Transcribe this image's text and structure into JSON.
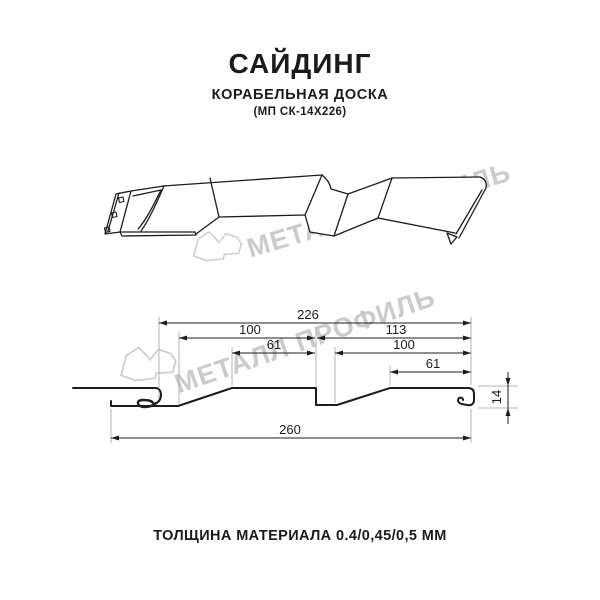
{
  "header": {
    "title": "САЙДИНГ",
    "subtitle": "КОРАБЕЛЬНАЯ ДОСКА",
    "code": "(МП СК-14Х226)"
  },
  "watermark": {
    "text": "МЕТАЛЛ ПРОФИЛЬ",
    "color": "#cbcbcb"
  },
  "icons": {
    "watermark_logo": "metall-profil-logo-outline"
  },
  "diagram": {
    "dims": {
      "total_width": "226",
      "left_face": "100",
      "left_top": "61",
      "right_span": "113",
      "right_face": "100",
      "right_top": "61",
      "overall_length": "260",
      "profile_height": "14"
    }
  },
  "footer": {
    "thickness": "ТОЛЩИНА МАТЕРИАЛА 0.4/0,45/0,5 ММ"
  },
  "colors": {
    "line": "#1c1c1c",
    "extension": "#b3b3b3",
    "watermark": "#cbcbcb",
    "background": "#ffffff"
  }
}
